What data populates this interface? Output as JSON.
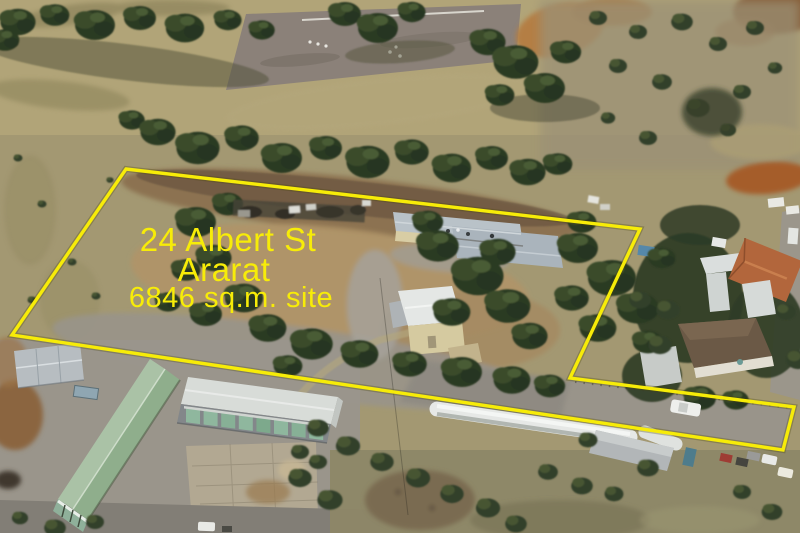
{
  "annotation": {
    "line1": "24 Albert St",
    "line2": "Ararat",
    "line3": "6846 sq.m. site",
    "text_color": "#f7ec08"
  },
  "boundary": {
    "points": "126,169 640,229 570,378 794,407 783,450 12,335",
    "color": "#f7ec08",
    "outline_shadow_color": "#4a4408"
  }
}
